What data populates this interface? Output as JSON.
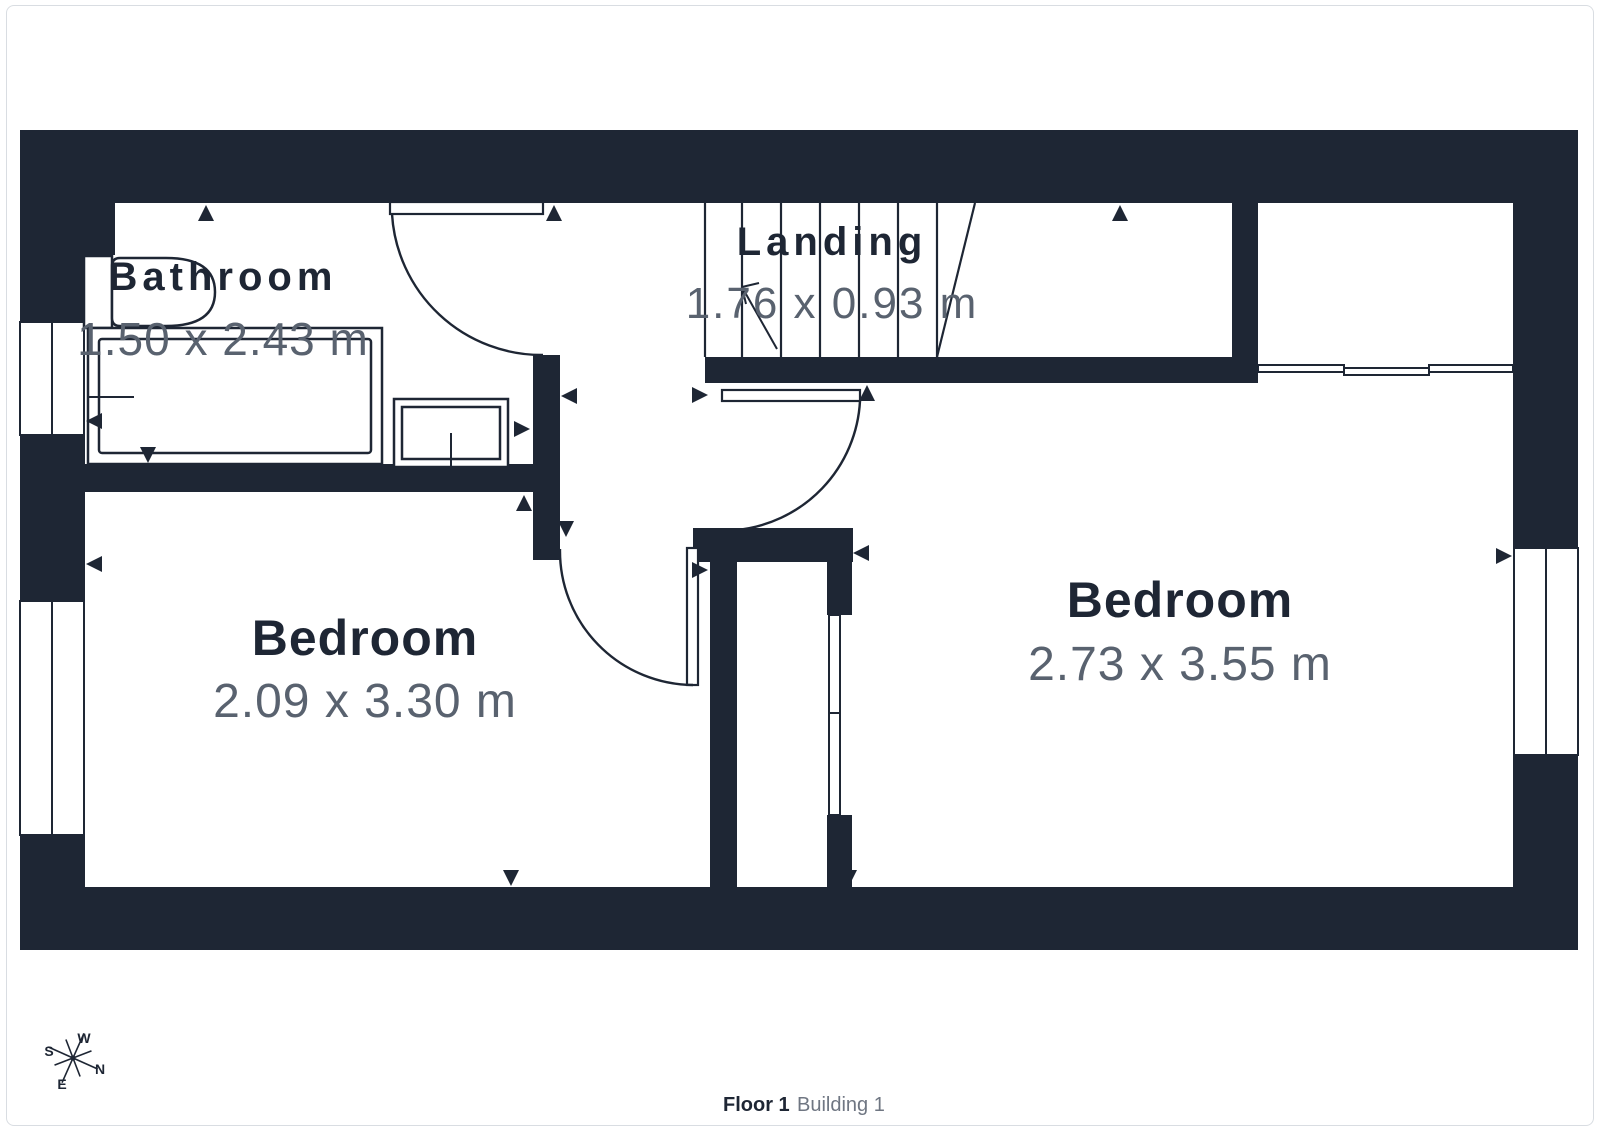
{
  "plan": {
    "rooms": [
      {
        "name": "Bathroom",
        "dimensions": "1.50 x 2.43 m"
      },
      {
        "name": "Landing",
        "dimensions": "1.76 x 0.93 m"
      },
      {
        "name": "Bedroom",
        "dimensions": "2.09 x 3.30 m"
      },
      {
        "name": "Bedroom",
        "dimensions": "2.73 x 3.55 m"
      }
    ],
    "compass": {
      "n": "N",
      "e": "E",
      "s": "S",
      "w": "W"
    },
    "colors": {
      "wall": "#1e2634",
      "dim": "#59626f",
      "muted": "#6f7682",
      "border": "#d9dde2",
      "bg": "#ffffff"
    }
  },
  "footer": {
    "floor_label": "Floor 1",
    "building_label": "Building 1"
  }
}
